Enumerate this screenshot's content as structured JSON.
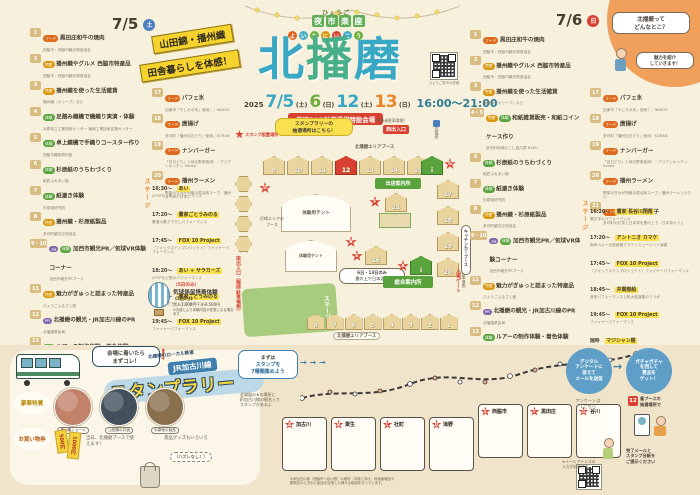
{
  "header": {
    "pref": "ひょうご",
    "brand": [
      "夜",
      "市",
      "楽",
      "座"
    ],
    "ruby": [
      "よ",
      "い",
      "ち",
      "に",
      "い",
      "こ",
      "う"
    ],
    "title_chars": [
      "北",
      "播",
      "磨"
    ],
    "year": "2025",
    "dates": [
      {
        "d": "7/5",
        "w": "(土)"
      },
      {
        "d": "6",
        "w": "(日)"
      },
      {
        "d": "12",
        "w": "(土)"
      },
      {
        "d": "13",
        "w": "(日)"
      }
    ],
    "time": "16:00～21:00",
    "venue": "尼崎P&R駐車場横特設会場",
    "qr_caption": "ひょうご夜市の詳細",
    "banner_line1": "山田錦・播州織",
    "banner_line2": "田舎暮らしを体感！"
  },
  "intro": {
    "q1": "北播磨って",
    "q2": "どんなとこ？",
    "a1": "魅力を紹介",
    "a2": "していきます！"
  },
  "day_left": {
    "date": "7/5",
    "dow": "土",
    "items": [
      {
        "no": "1",
        "badges": [
          "フード"
        ],
        "title": "黒田庄和牛の焼肉",
        "sub": "西脇市・西脇市観光物産協会"
      },
      {
        "no": "2",
        "badges": [
          "特産"
        ],
        "title": "播州織やグルメ 西脇市特産品",
        "sub": "西脇市・西脇市観光物産協会"
      },
      {
        "no": "3",
        "badges": [
          "特産"
        ],
        "title": "播州織を使った生活雑貨",
        "sub": "播州織（オリーブ）など"
      },
      {
        "no": "4",
        "badges": [
          "体験"
        ],
        "title": "足踏み織機で機織り実演・体験",
        "sub": "兵庫県立工業技術センター 繊維工業技術支援センター"
      },
      {
        "no": "5",
        "badges": [
          "体験"
        ],
        "title": "卓上織機で手織りコースター作り",
        "sub": "西脇市織物資料館"
      },
      {
        "no": "6",
        "badges": [
          "体験"
        ],
        "title": "杉原紙のうちわづくり",
        "sub": "紙匠ふれあい館"
      },
      {
        "no": "7",
        "badges": [
          "体験"
        ],
        "title": "紙漉き体験",
        "sub": "杉原紙研究所"
      },
      {
        "no": "8",
        "badges": [
          "特産"
        ],
        "title": "播州織・杉原紙製品",
        "sub": "多可町観光交流協会"
      },
      {
        "no": "9・10",
        "badges": [
          "PR",
          "体験"
        ],
        "title": "加西市観光PR／気球VR体験コーナー",
        "sub": "加西市観光PRブース"
      },
      {
        "no": "11",
        "badges": [
          "特産"
        ],
        "title": "魅力がぎゅっと詰まった特産品",
        "sub": "ひょうごふるさと館"
      },
      {
        "no": "12",
        "badges": [
          "PR"
        ],
        "title": "北播磨の観光・JR加古川線のPR",
        "sub": "北播磨県民局"
      },
      {
        "no": "13",
        "badges": [
          "体験"
        ],
        "title": "ルアーの制作体験・着色体験",
        "sub": "加東市観光協会"
      },
      {
        "no": "14",
        "badges": [
          "PR",
          "体験"
        ],
        "title": "三木市の観光・特産品のPR",
        "sub": "三木市のフィールドパビリオン"
      },
      {
        "no": "15",
        "badges": [
          "フード"
        ],
        "title": "特A地区産 山田錦の利酒とおつまみ",
        "sub": "株式会社神結"
      },
      {
        "no": "16",
        "badges": [
          "特産"
        ],
        "title": "tamaki niime作品の展示販売",
        "sub": "有限会社玉木新雌"
      }
    ],
    "foods": [
      {
        "no": "17",
        "badges": [
          "フード"
        ],
        "title": "パフェ氷",
        "sub": "加東市「やしろの氷」使用！／INVIGO"
      },
      {
        "no": "18",
        "badges": [
          "フード"
        ],
        "title": "唐揚げ",
        "sub": "多可町「播州百日どり」使用／SORAN"
      },
      {
        "no": "19",
        "badges": [
          "フード"
        ],
        "title": "ナンバーガー",
        "sub": "「百日どり」と地元野菜使用！／アジアンキッチン Sanka"
      },
      {
        "no": "20",
        "badges": [
          "フード"
        ],
        "title": "播州ラーメン",
        "sub": "野菜の甘みが特徴の醤油系スープ／播州ラーメンひすい"
      }
    ],
    "stage_label": "ステージ",
    "stage": [
      {
        "time": "16:30～",
        "name": "あい",
        "sub": "J-POPなど歌のパフォーマンス"
      },
      {
        "time": "17:20～",
        "name": "書家ごとうみのる",
        "sub": "書道の書き下ろしパフォーマンス"
      },
      {
        "time": "17:45～",
        "name": "FOX 10 Project",
        "sub": "（フォックステンプロジェクト）ファイヤーパフォーマンス"
      },
      {
        "time": "18:20～",
        "name": "あい + サラカーズ",
        "sub": "J-POPなど歌のパフォーマンス"
      },
      {
        "time": "19:20～",
        "name": "書家ごとうみのる",
        "sub": "書道の書き下ろしパフォーマンス"
      },
      {
        "time": "19:45～",
        "name": "FOX 10 Project",
        "sub": "ファイヤーパフォーマンス"
      }
    ],
    "balloon": {
      "only": "（5日のみ）",
      "title": "気球係留搭乗体験",
      "per": "《1回5分》",
      "price": "大人1,000円・小人500円",
      "note": "※天候により体験内容が変更になる場合あり"
    }
  },
  "day_right": {
    "date": "7/6",
    "dow": "日",
    "items": [
      {
        "no": "1",
        "badges": [
          "フード"
        ],
        "title": "黒田庄和牛の焼肉",
        "sub": "西脇市・西脇市観光物産協会"
      },
      {
        "no": "2",
        "badges": [
          "特産"
        ],
        "title": "播州織やグルメ 西脇市特産品",
        "sub": "西脇市・西脇市観光物産協会"
      },
      {
        "no": "3",
        "badges": [
          "特産"
        ],
        "title": "播州織を使った生活雑貨",
        "sub": "播州織（オリーブ）など"
      },
      {
        "no": "4・5",
        "badges": [
          "特産",
          "体験"
        ],
        "title": "和紙雑貨販売・和紙コインケース作り",
        "sub": "多可町地域おこし協力隊 RAKU"
      },
      {
        "no": "6",
        "badges": [
          "体験"
        ],
        "title": "杉原紙のうちわづくり",
        "sub": "紙匠ふれあい館"
      },
      {
        "no": "7",
        "badges": [
          "体験"
        ],
        "title": "紙漉き体験",
        "sub": "杉原紙研究所"
      },
      {
        "no": "8",
        "badges": [
          "特産"
        ],
        "title": "播州織・杉原紙製品",
        "sub": "多可町観光交流協会"
      },
      {
        "no": "9・10",
        "badges": [
          "PR",
          "体験"
        ],
        "title": "加西市観光PR／気球VR体験コーナー",
        "sub": "加西市観光PRブース"
      },
      {
        "no": "11",
        "badges": [
          "特産"
        ],
        "title": "魅力がぎゅっと詰まった特産品",
        "sub": "ひょうごふるさと館"
      },
      {
        "no": "12",
        "badges": [
          "PR"
        ],
        "title": "北播磨の観光・JR加古川線のPR",
        "sub": "北播磨県民局"
      },
      {
        "no": "13",
        "badges": [
          "体験"
        ],
        "title": "ルアーの制作体験・着色体験",
        "sub": "加東市観光協会"
      },
      {
        "no": "14",
        "badges": [
          "PR",
          "体験"
        ],
        "title": "三木市の観光・特産品のPR",
        "sub": "三木市のフィールドパビリオン"
      },
      {
        "no": "15",
        "badges": [
          "フード"
        ],
        "title": "特A地区産 山田錦の利酒とおつまみ",
        "sub": "株式会社神結"
      },
      {
        "no": "16",
        "badges": [
          "特産"
        ],
        "title": "tamaki niime作品の展示販売",
        "sub": "有限会社玉木新雌"
      }
    ],
    "foods": [
      {
        "no": "17",
        "badges": [
          "フード"
        ],
        "title": "パフェ氷",
        "sub": "加東市「やしろの氷」使用！／INVIGO"
      },
      {
        "no": "18",
        "badges": [
          "フード"
        ],
        "title": "唐揚げ",
        "sub": "多可町「播州百日どり」使用／SORAN"
      },
      {
        "no": "19",
        "badges": [
          "フード"
        ],
        "title": "ナンバーガー",
        "sub": "「百日どり」と地元野菜使用！／アジアンキッチン Sanka"
      },
      {
        "no": "20",
        "badges": [
          "フード"
        ],
        "title": "播州ラーメン",
        "sub": "野菜の甘みが特徴の醤油系スープ／播州ラーメンひすい"
      },
      {
        "no": "21",
        "badges": [
          "フード"
        ],
        "title": "お茶とお茶菓子",
        "sub": "多可町の紅茶と日本茶を畳の上で／日本茶カフェ"
      }
    ],
    "stage_label": "ステージ",
    "stage": [
      {
        "time": "16:20～",
        "name": "書家 長谷川翔南",
        "sub": "墨文字のパフォーマンス"
      },
      {
        "time": "17:20～",
        "name": "アントニオ カマケ",
        "sub": "南米ペルー伝統楽器でラテンミュージック演奏"
      },
      {
        "time": "17:45～",
        "name": "FOX 10 Project",
        "sub": "（フォックステンプロジェクト）ファイヤーパフォーマンス"
      },
      {
        "time": "18:45～",
        "name": "井関春絵",
        "sub": "音楽パフォーマンスと和太鼓演奏のコラボ"
      },
      {
        "time": "19:45～",
        "name": "FOX 10 Project",
        "sub": "ファイヤーパフォーマンス"
      },
      {
        "time": "随時",
        "name": "マジシャン樹",
        "sub": "マジック大道芸"
      }
    ]
  },
  "map": {
    "legend": "スタンプ設置場所",
    "lottery_bubble1": "スタンプラリーの",
    "lottery_bubble2": "抽選場所はこちら！",
    "area_top": "北播磨エリアブース",
    "area_bottom": "北播磨エリアブース",
    "parking_note": "（関係者駐車場側）",
    "west_exit": "西出入口",
    "facility": "充電所",
    "booths_top": [
      "9",
      "10",
      "11"
    ],
    "booth_lottery": "12",
    "booths_top2": [
      "13",
      "14",
      "15"
    ],
    "info_i": "i",
    "info_i2": "i",
    "booth_info_label": "出店案内所",
    "booths_right": [
      "17",
      "18",
      "19",
      "20"
    ],
    "booth_21": "21",
    "booth_16": "16",
    "booths_bottom": [
      "8",
      "7",
      "6",
      "5",
      "4",
      "3",
      "2",
      "1"
    ],
    "tent_label": "体験用テント",
    "tent_label2": "体験用テント",
    "stage_label": "ステージ",
    "info_center": "総合案内所",
    "south_exit": "南出入口（臨時駐車場側）",
    "gate": "入場ゲート",
    "gate_side": "（アルス駐車場側）",
    "kitchen_car": "キッチンカーブース",
    "sake_note1": "6日・13日のみ",
    "sake_note2": "畳の上で日本酒を",
    "ama_area1": "尼崎エリアの",
    "ama_area2": "ブース",
    "stars": {
      "a": "A",
      "b": "B",
      "c": "C",
      "d": "D",
      "e": "E",
      "f": "F",
      "g": "G"
    }
  },
  "bottom": {
    "arrive1": "会場に着いたら",
    "arrive2": "まずコレ！",
    "bang": "！",
    "local_line": "北播磨のローカル鉄道",
    "jr_line": "JR加古川線",
    "rally_title": "スタンプラリー",
    "prize_label": "豪華特賞",
    "coupon_label": "お買い物券",
    "prizes": [
      "播州織ショール",
      "山田錦のお酒",
      "杉原紙の製品"
    ],
    "tickets": [
      "500円",
      "1000円"
    ],
    "ticket_note": "当日、北播磨ブースで使えます！",
    "goods_note": "景品グッズもいろいろ",
    "goods_note2": "（ハズレなし！）",
    "step1a": "まずは",
    "step1b": "スタンプを",
    "step1c": "7種類集めよう",
    "arrows": "→ → →",
    "step1_note1": "会場図の★の場所に",
    "step1_note2": "JR加古川線の駅名入り",
    "step1_note3": "スタンプがあるよ",
    "stations": [
      {
        "letter": "A",
        "name": "加古川"
      },
      {
        "letter": "B",
        "name": "粟生"
      },
      {
        "letter": "C",
        "name": "社町"
      },
      {
        "letter": "D",
        "name": "滝野"
      },
      {
        "letter": "E",
        "name": "西脇市"
      },
      {
        "letter": "F",
        "name": "黒田庄"
      },
      {
        "letter": "G",
        "name": "谷川"
      }
    ],
    "jr_note1": "※JR加古川線（西脇市～谷川間）の維持・存続に向け、利用者増加や",
    "jr_note2": "駅周辺のにぎわい創出を目指した様々な取組を行っています。",
    "step2a": "デジタル",
    "step2b": "アンケートに",
    "step2c": "答えて",
    "step2d": "メールを送信",
    "big_arrow": "→",
    "step3a": "ガチャガチャ",
    "step3b": "を回して",
    "step3c": "賞品を",
    "step3d": "ゲット！",
    "qr_note1": "アンケートは",
    "qr_note2": "↓こちら",
    "mail_note1": "※メールアドレスの",
    "mail_note2": "入力が必要です",
    "booth12_no": "12",
    "booth12_note1": "番ブースの",
    "booth12_note2": "抽選場所で",
    "final_note1": "完了メールと",
    "final_note2": "スタンプ台紙を",
    "final_note3": "ご提示ください"
  }
}
